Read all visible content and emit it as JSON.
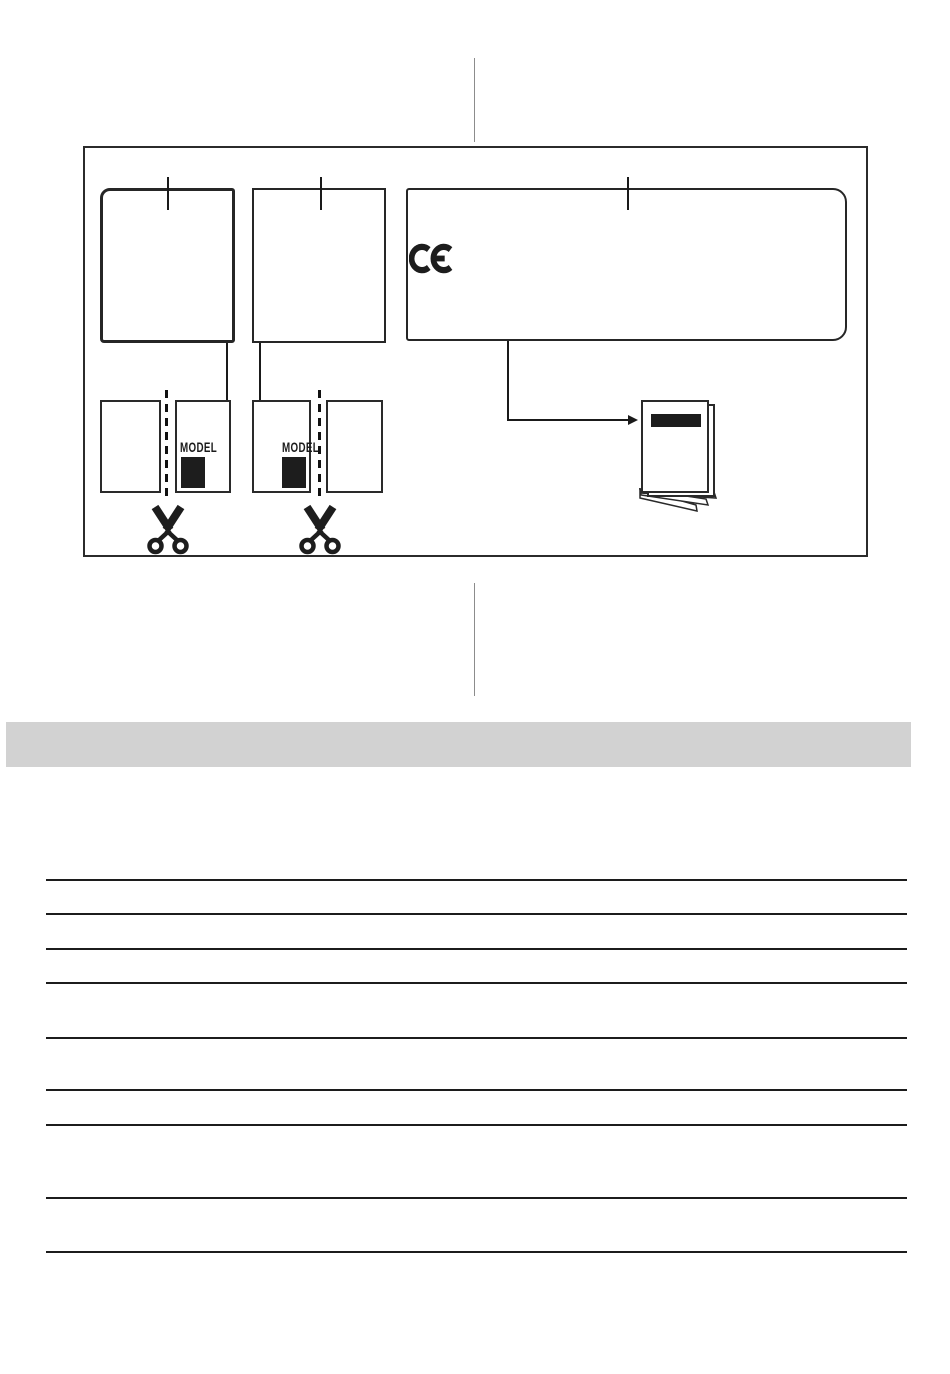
{
  "diagram": {
    "model_cards": [
      {
        "label": "MODEL"
      },
      {
        "label": "MODEL"
      }
    ],
    "icons": [
      "ce-mark-icon",
      "scissors-icon",
      "manual-booklet-icon"
    ]
  },
  "colors": {
    "line_black": "#1c1c1c",
    "frame_black": "#2b2b2b",
    "title_bar_gray": "#d2d2d2",
    "separator_gray": "#8c8c8c",
    "model_block_black": "#1d1d1d"
  },
  "notes_table": {
    "rule_count": 9
  }
}
